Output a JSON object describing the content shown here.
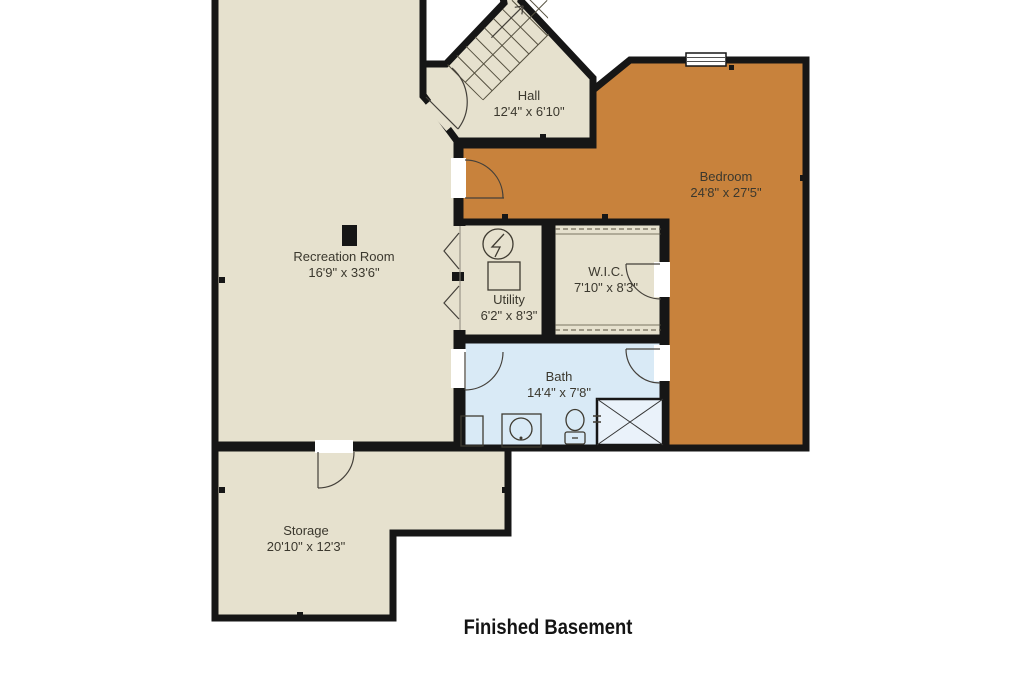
{
  "title": "Finished Basement",
  "colors": {
    "room_fill": "#E6E1CE",
    "bedroom_fill": "#C8823C",
    "bath_fill": "#D9EAF6",
    "wall": "#161616",
    "shower_fill": "#EAF2FA"
  },
  "rooms": {
    "hall": {
      "name": "Hall",
      "dims": "12'4\" x 6'10\""
    },
    "bedroom": {
      "name": "Bedroom",
      "dims": "24'8\" x 27'5\""
    },
    "recreation": {
      "name": "Recreation Room",
      "dims": "16'9\" x 33'6\""
    },
    "utility": {
      "name": "Utility",
      "dims": "6'2\" x 8'3\""
    },
    "wic": {
      "name": "W.I.C.",
      "dims": "7'10\" x 8'3\""
    },
    "bath": {
      "name": "Bath",
      "dims": "14'4\" x 7'8\""
    },
    "storage": {
      "name": "Storage",
      "dims": "20'10\" x 12'3\""
    }
  }
}
